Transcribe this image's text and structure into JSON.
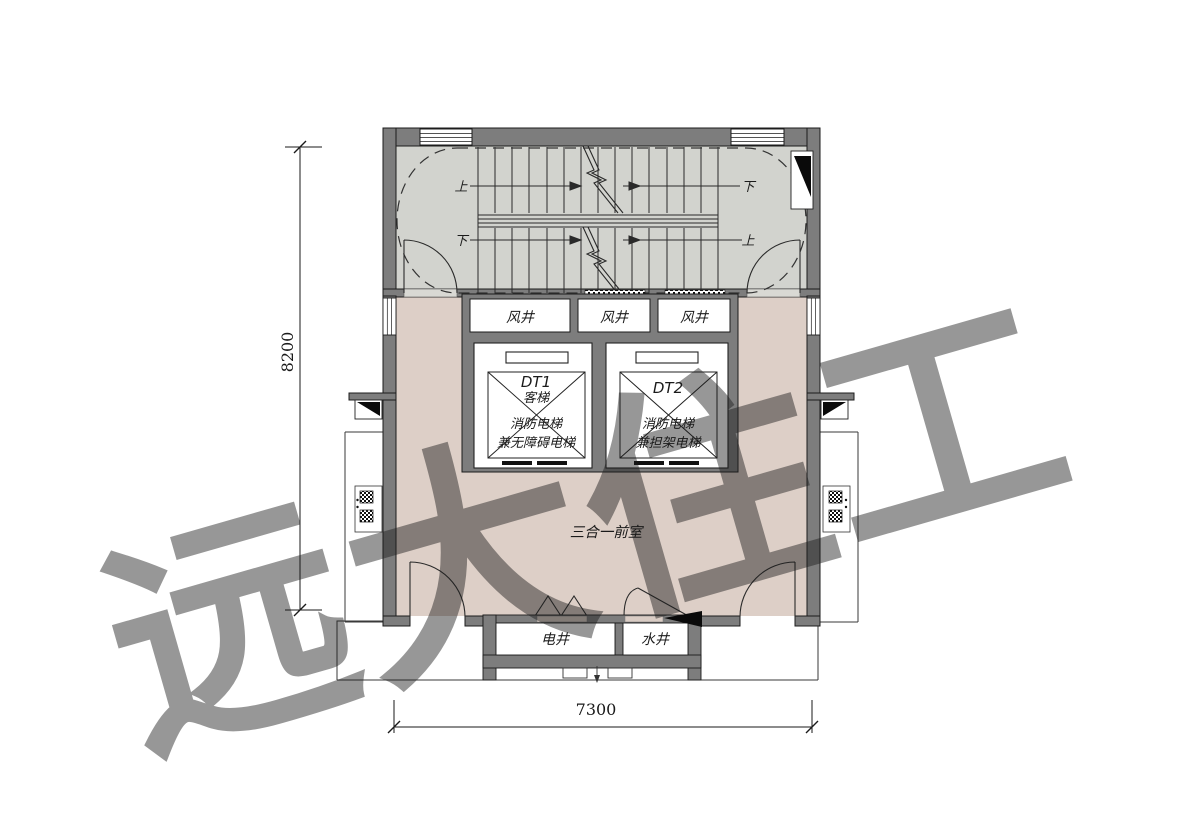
{
  "plan": {
    "watermark": "远大住工",
    "room_label": "三合一前室",
    "dimensions": {
      "left": "8200",
      "bottom": "7300"
    },
    "stair": {
      "upper_left": "上",
      "upper_right": "下",
      "lower_left": "下",
      "lower_right": "上"
    },
    "air_shafts": [
      "风井",
      "风井",
      "风井"
    ],
    "elevator1": {
      "id": "DT1",
      "cab": "客梯",
      "fire": "消防电梯",
      "access": "兼无障碍电梯"
    },
    "elevator2": {
      "id": "DT2",
      "fire": "消防电梯",
      "stretcher": "兼担架电梯"
    },
    "bottom_shafts": {
      "electrical": "电井",
      "water": "水井"
    },
    "colors": {
      "wall": "#7d7d7d",
      "stair_fill": "#d2d3ce",
      "room_fill": "#ddcfc7",
      "line": "#1f1f1f"
    }
  }
}
